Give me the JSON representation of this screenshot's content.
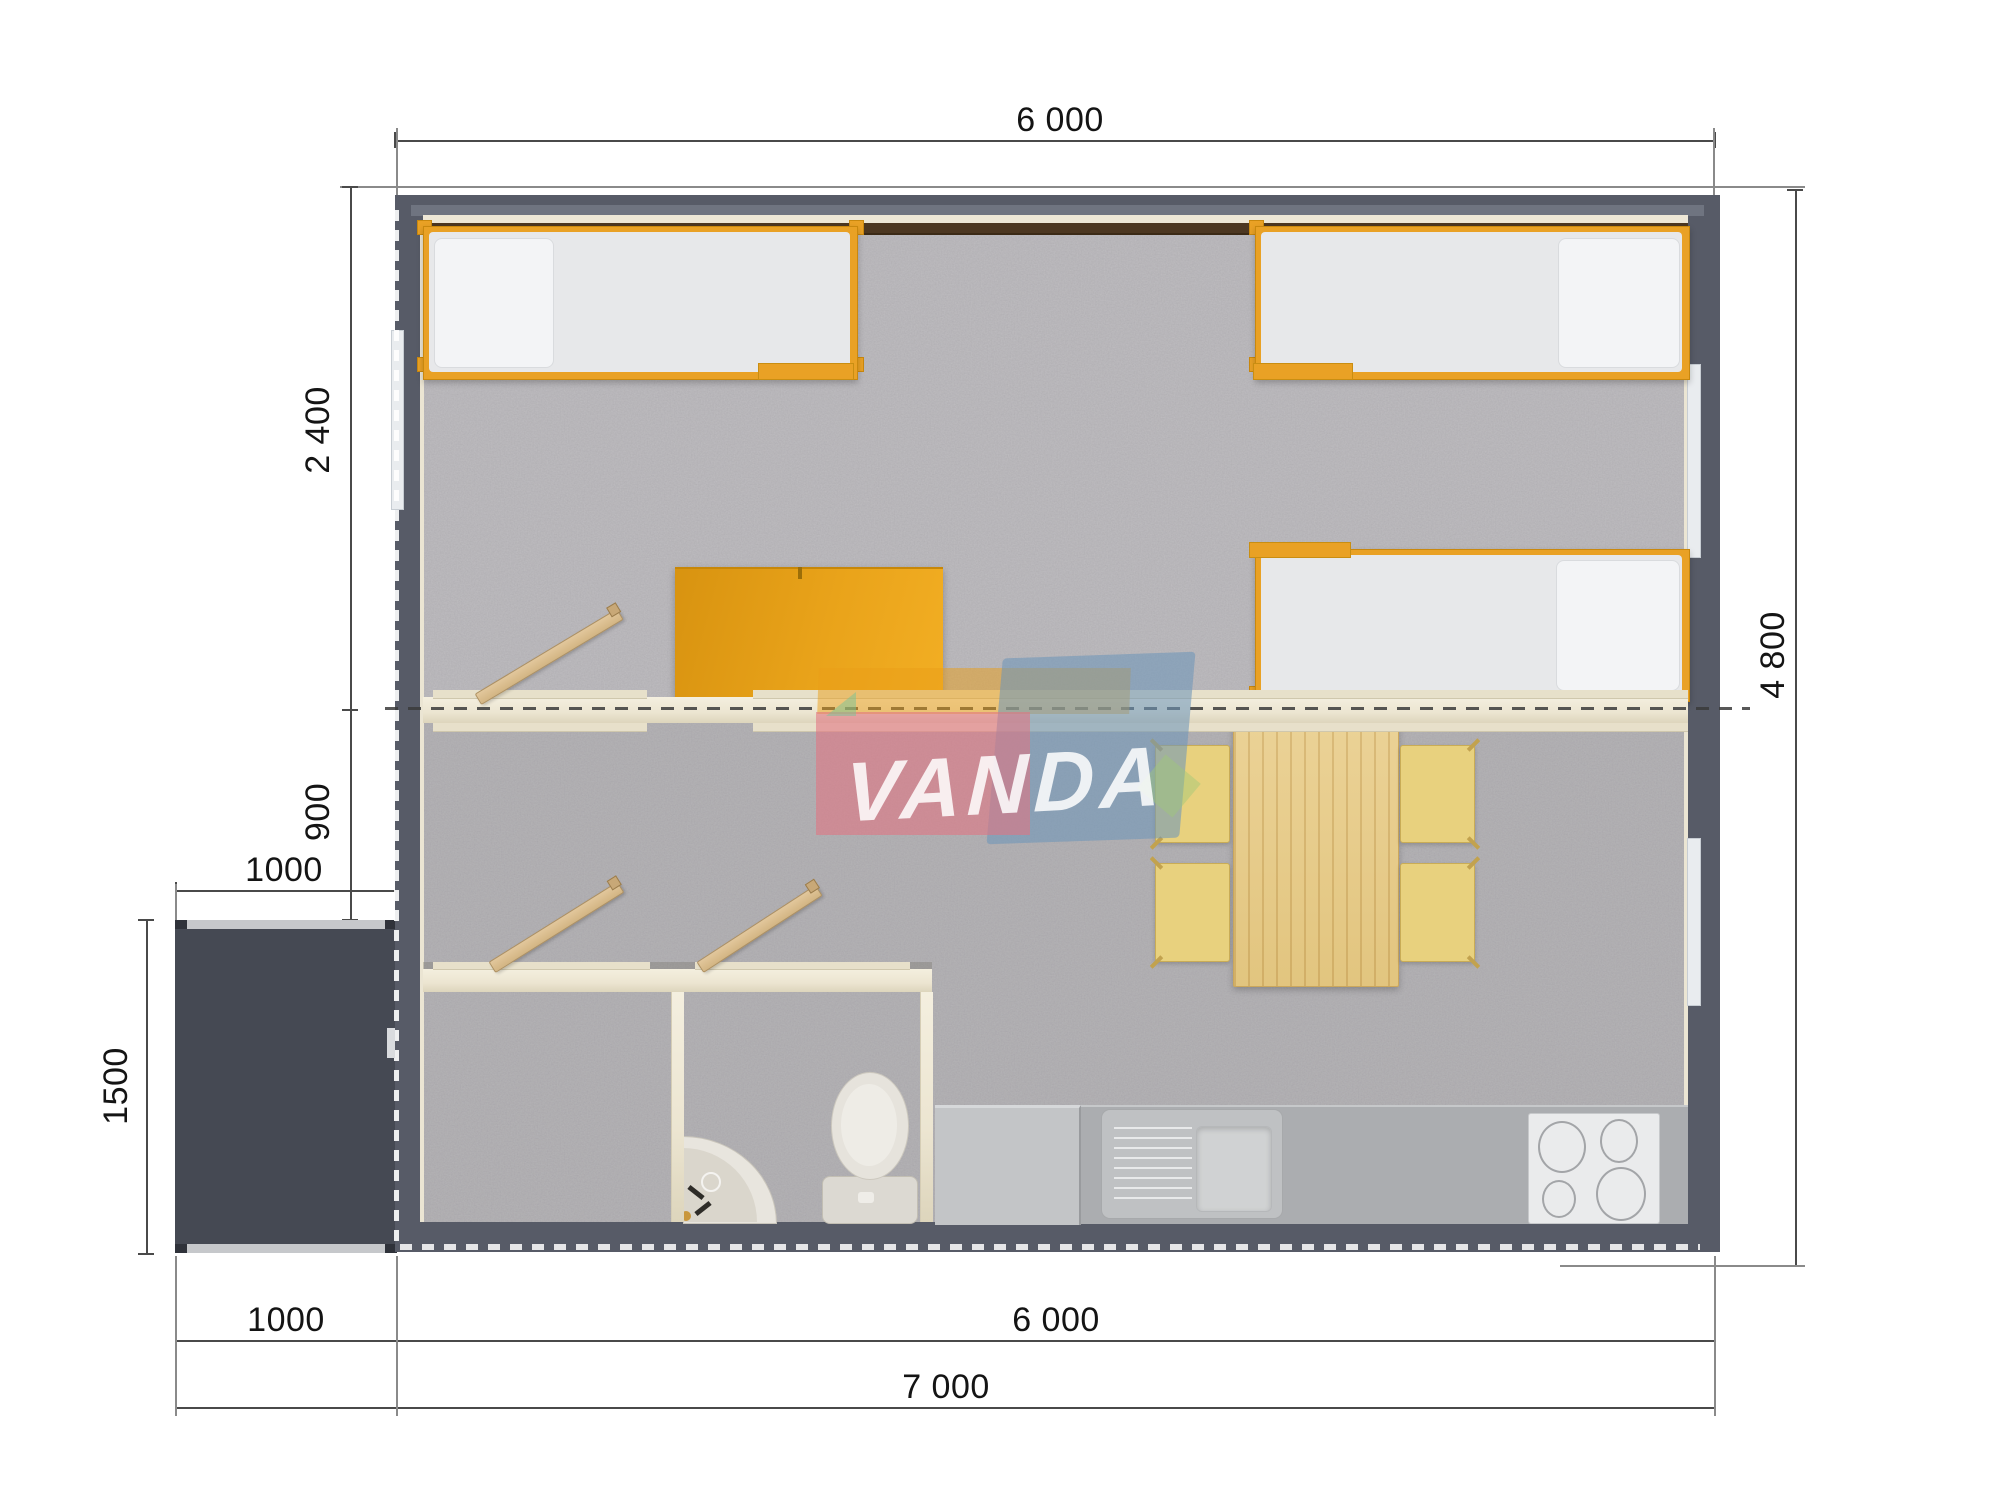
{
  "plan": {
    "type": "floor-plan-top-view",
    "watermark": {
      "text": "VANDA"
    },
    "dimensions": {
      "width_top": "6 000",
      "height_right": "4 800",
      "bedroom_depth": "2 400",
      "hall_depth": "900",
      "porch_width_top": "1000",
      "porch_depth": "1500",
      "porch_width_bottom": "1000",
      "house_width_bottom": "6 000",
      "total_width": "7 000"
    },
    "rooms": [
      "bedroom",
      "living-kitchen",
      "wc-room-1",
      "wc-room-2",
      "porch"
    ],
    "furniture": [
      "single-bed",
      "single-bed",
      "single-bed",
      "wardrobe",
      "dining-table",
      "chair",
      "chair",
      "chair",
      "chair",
      "kitchen-counter",
      "kitchen-sink",
      "cooktop",
      "toilet",
      "corner-washbasin",
      "door",
      "door",
      "door",
      "entry-door"
    ],
    "colors": {
      "wall": "#575B67",
      "porch": "#454953",
      "floor": "#B5B3B6",
      "accent_orange": "#E9A125",
      "interior_wall_cream": "#EFE9D8",
      "wood_door": "#DCC094",
      "table_wood": "#E8CE8C",
      "chair_yellow": "#E8D17E",
      "counter_gray": "#ABADB0",
      "fixture_white": "#E6E3DC",
      "dimension_line": "#4A4A4A",
      "watermark_pink": "#E27382",
      "watermark_blue": "#6E96B9"
    }
  }
}
